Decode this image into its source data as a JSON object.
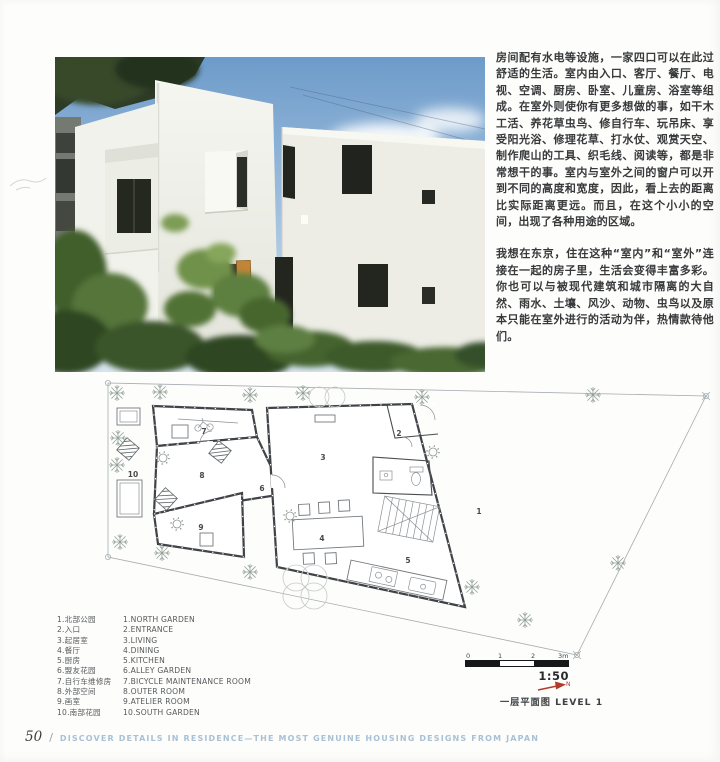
{
  "article": {
    "paragraphs": [
      "房间配有水电等设施，一家四口可以在此过舒适的生活。室内由入口、客厅、餐厅、电视、空调、厨房、卧室、儿童房、浴室等组成。在室外则使你有更多想做的事，如干木工活、养花草虫鸟、修自行车、玩吊床、享受阳光浴、修理花草、打水仗、观赏天空、制作爬山的工具、织毛线、阅读等，都是非常想干的事。室内与室外之间的窗户可以开到不同的高度和宽度，因此，看上去的距离比实际距离更远。而且，在这个小小的空间，出现了各种用途的区域。",
      "我想在东京，住在这种“室内”和“室外”连接在一起的房子里，生活会变得丰富多彩。你也可以与被现代建筑和城市隔离的大自然、雨水、土壤、风沙、动物、虫鸟以及原本只能在室外进行的活动为伴，热情款待他们。"
    ]
  },
  "legend": {
    "items": [
      {
        "zh": "1.北部公园",
        "en": "1.NORTH GARDEN"
      },
      {
        "zh": "2.入口",
        "en": "2.ENTRANCE"
      },
      {
        "zh": "3.起居室",
        "en": "3.LIVING"
      },
      {
        "zh": "4.餐厅",
        "en": "4.DINING"
      },
      {
        "zh": "5.厨房",
        "en": "5.KITCHEN"
      },
      {
        "zh": "6.盟友花园",
        "en": "6.ALLEY GARDEN"
      },
      {
        "zh": "7.自行车维修房",
        "en": "7.BICYCLE MAINTENANCE ROOM"
      },
      {
        "zh": "8.外部空间",
        "en": "8.OUTER ROOM"
      },
      {
        "zh": "9.画室",
        "en": "9.ATELIER ROOM"
      },
      {
        "zh": "10.南部花园",
        "en": "10.SOUTH GARDEN"
      }
    ]
  },
  "plan": {
    "room_numbers": [
      "1",
      "2",
      "3",
      "4",
      "5",
      "6",
      "7",
      "8",
      "9",
      "10"
    ],
    "scale": {
      "ticks": [
        "0",
        "1",
        "2",
        "3m"
      ],
      "ratio": "1:50"
    },
    "north_label": "N",
    "caption": "一层平面图 LEVEL 1"
  },
  "footer": {
    "page_number": "50",
    "separator": "/",
    "title": "DISCOVER DETAILS IN RESIDENCE—THE MOST GENUINE HOUSING DESIGNS FROM JAPAN"
  },
  "colors": {
    "footer_blue": "#a8c1d4",
    "north_arrow_red": "#b23a2b"
  }
}
